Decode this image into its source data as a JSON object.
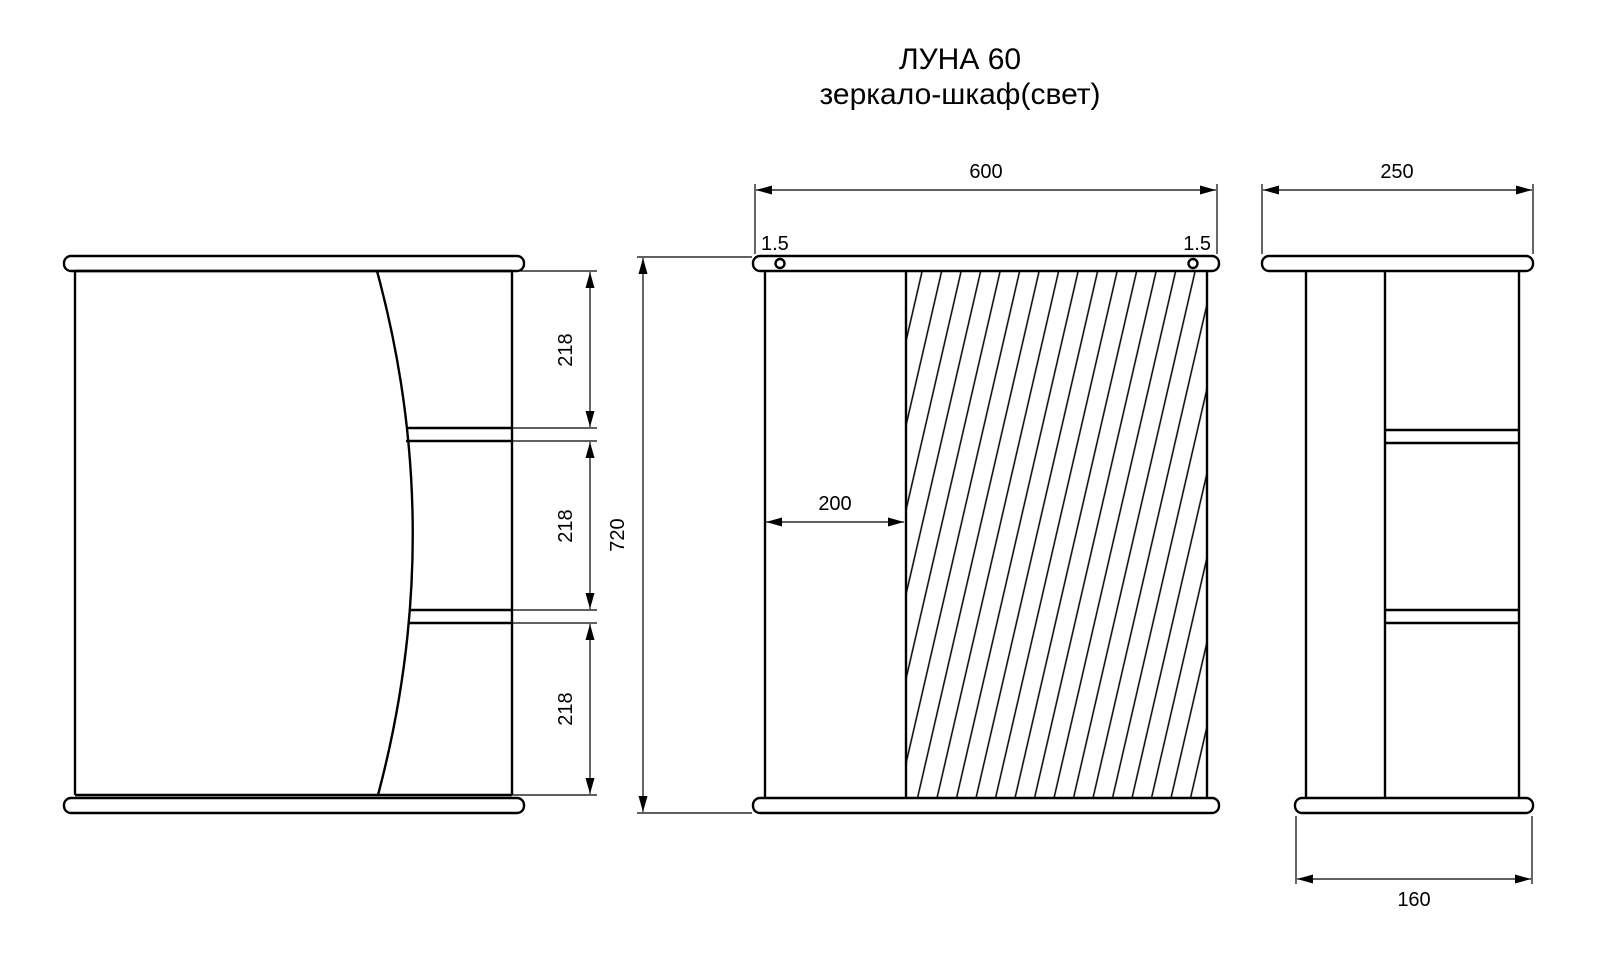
{
  "title": {
    "line1": "ЛУНА 60",
    "line2": "зеркало-шкаф(свет)"
  },
  "dimensions": {
    "left_view": {
      "shelf_spacings": [
        "218",
        "218",
        "218"
      ]
    },
    "front_view": {
      "overall_width": "600",
      "overall_height": "720",
      "door_offset": "200",
      "top_inset_left": "1.5",
      "top_inset_right": "1.5"
    },
    "side_view": {
      "overall_depth": "250",
      "plinth_depth": "160"
    }
  },
  "colors": {
    "line": "#000000",
    "background": "#ffffff"
  }
}
